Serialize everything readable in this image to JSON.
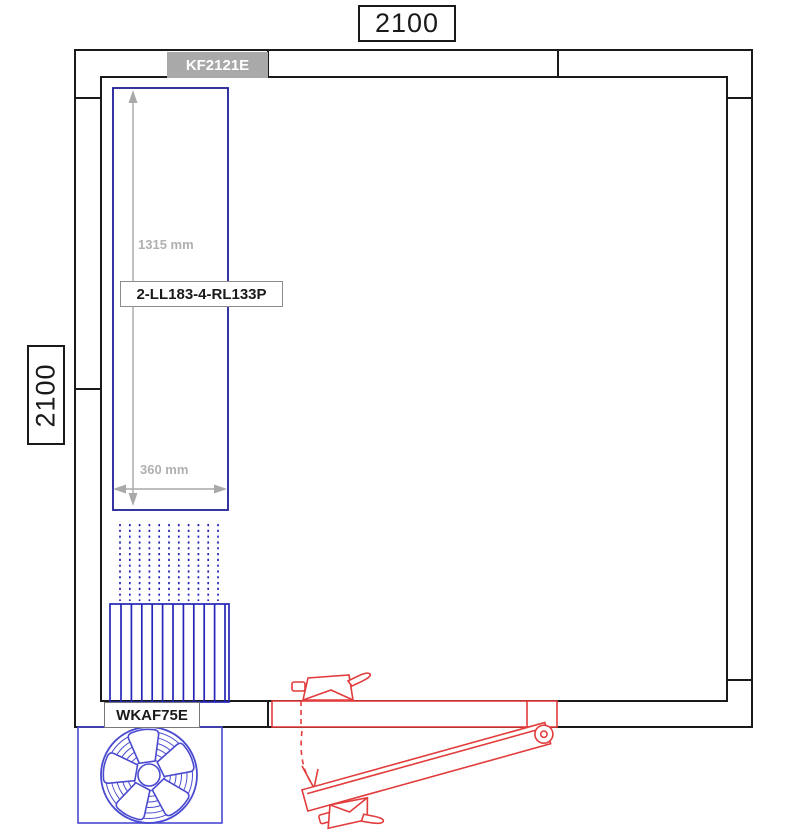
{
  "room": {
    "dim_top": "2100",
    "dim_left": "2100"
  },
  "units": {
    "ceiling_unit_label": "KF2121E",
    "shelving_label": "2-LL183-4-RL133P",
    "fan_unit_label": "WKAF75E"
  },
  "shelving_dimensions": {
    "length": "1315 mm",
    "width": "360 mm"
  },
  "colors": {
    "wall_line": "#1a1a1a",
    "shelf_blue": "#1f1f96",
    "coil_blue": "#2525b8",
    "fan_blue": "#4a4ad0",
    "door_red": "#e23c3c",
    "dim_gray": "#a9a9a9",
    "panel_gray": "#a9a9a9",
    "dim_text_gray": "#b0b0b0"
  }
}
